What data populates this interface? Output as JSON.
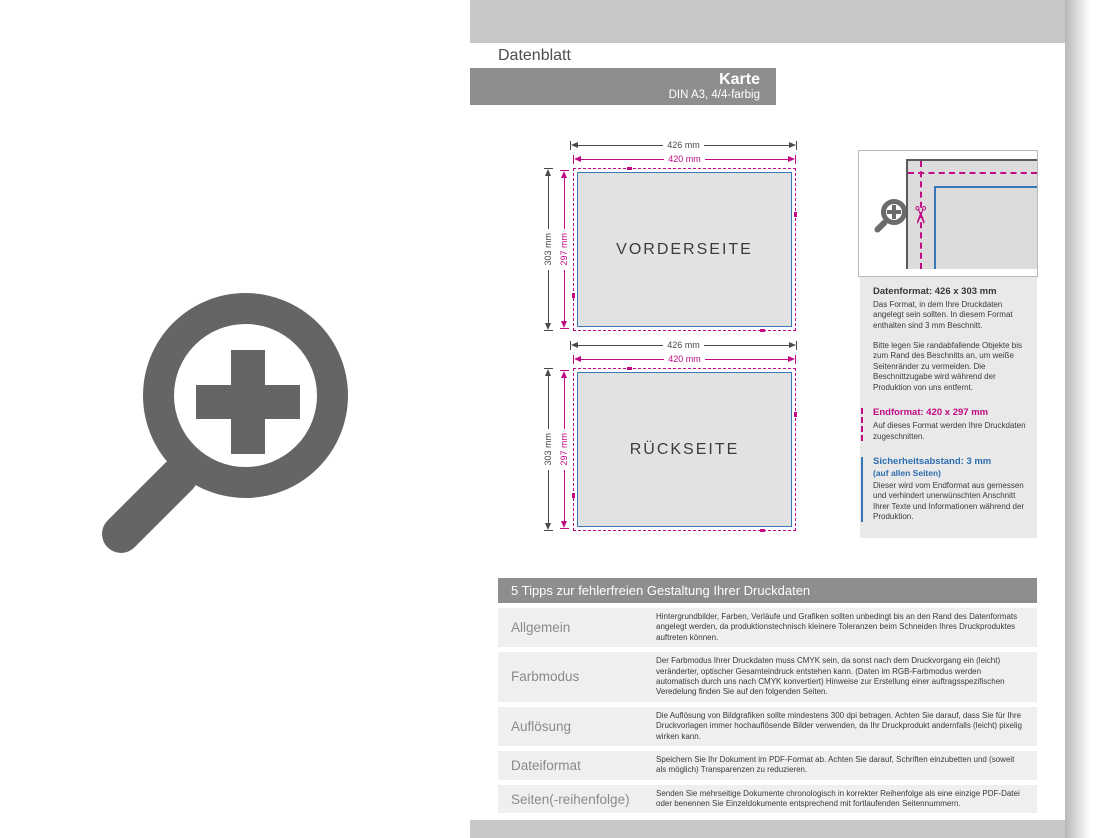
{
  "header": {
    "tab": "Datenblatt",
    "product": "Karte",
    "subtitle": "DIN A3, 4/4-farbig"
  },
  "colors": {
    "magenta": "#c20a84",
    "blue": "#3878b8",
    "band_gray": "#c7c7c7",
    "bar_gray": "#8e8e8e",
    "card_fill": "#e2e2e2"
  },
  "icons": {
    "left_icon": "zoom-plus-icon",
    "detail_icon": "magnifier-plus-icon",
    "scissors_glyph": "✂"
  },
  "diagrams": [
    {
      "label": "VORDERSEITE",
      "width_bleed": "426 mm",
      "width_final": "420 mm",
      "height_bleed": "303 mm",
      "height_final": "297 mm"
    },
    {
      "label": "RÜCKSEITE",
      "width_bleed": "426 mm",
      "width_final": "420 mm",
      "height_bleed": "303 mm",
      "height_final": "297 mm"
    }
  ],
  "info_panel": {
    "sections": [
      {
        "title": "Datenformat: 426 x 303 mm",
        "p1": "Das Format, in dem Ihre Druckdaten angelegt sein sollten. In diesem Format enthalten sind 3 mm Beschnitt.",
        "p2": "Bitte legen Sie randabfallende Objekte bis zum Rand des Beschnitts an, um weiße Seitenränder zu vermeiden. Die Beschnittzugabe wird während der Produktion von uns entfernt."
      },
      {
        "title": "Endformat: 420 x 297 mm",
        "p1": "Auf dieses Format werden Ihre Druckdaten zugeschnitten."
      },
      {
        "title": "Sicherheitsabstand: 3 mm",
        "subtitle": "(auf allen Seiten)",
        "p1": "Dieser wird vom Endformat aus gemessen und verhindert unerwünschten Anschnitt Ihrer Texte und Informationen während der Produktion."
      }
    ]
  },
  "tips": {
    "title": "5 Tipps zur fehlerfreien Gestaltung Ihrer Druckdaten",
    "rows": [
      {
        "label": "Allgemein",
        "text": "Hintergrundbilder, Farben, Verläufe und Grafiken sollten unbedingt bis an den Rand des Datenformats angelegt werden, da produktionstechnisch kleinere Toleranzen beim Schneiden Ihres Druckproduktes auftreten können."
      },
      {
        "label": "Farbmodus",
        "text": "Der Farbmodus Ihrer Druckdaten muss CMYK sein, da sonst nach dem Druckvorgang ein (leicht) veränderter, optischer Gesamteindruck entstehen kann. (Daten im RGB-Farbmodus werden automatisch durch uns nach CMYK konvertiert) Hinweise zur Erstellung einer auftragsspezifischen Veredelung finden Sie auf den folgenden Seiten."
      },
      {
        "label": "Auflösung",
        "text": "Die Auflösung von Bildgrafiken sollte mindestens 300 dpi betragen. Achten Sie darauf, dass Sie für Ihre Druckvorlagen immer hochauflösende Bilder verwenden, da Ihr Druckprodukt andernfalls (leicht) pixelig wirken kann."
      },
      {
        "label": "Dateiformat",
        "text": "Speichern Sie Ihr Dokument im PDF-Format ab. Achten Sie darauf, Schriften einzubetten und (soweit als möglich) Transparenzen zu reduzieren."
      },
      {
        "label": "Seiten(-reihenfolge)",
        "text": "Senden Sie mehrseitige Dokumente chronologisch in korrekter Reihenfolge als eine einzige PDF-Datei oder benennen Sie Einzeldokumente entsprechend mit fortlaufenden Seitennummern."
      }
    ]
  }
}
